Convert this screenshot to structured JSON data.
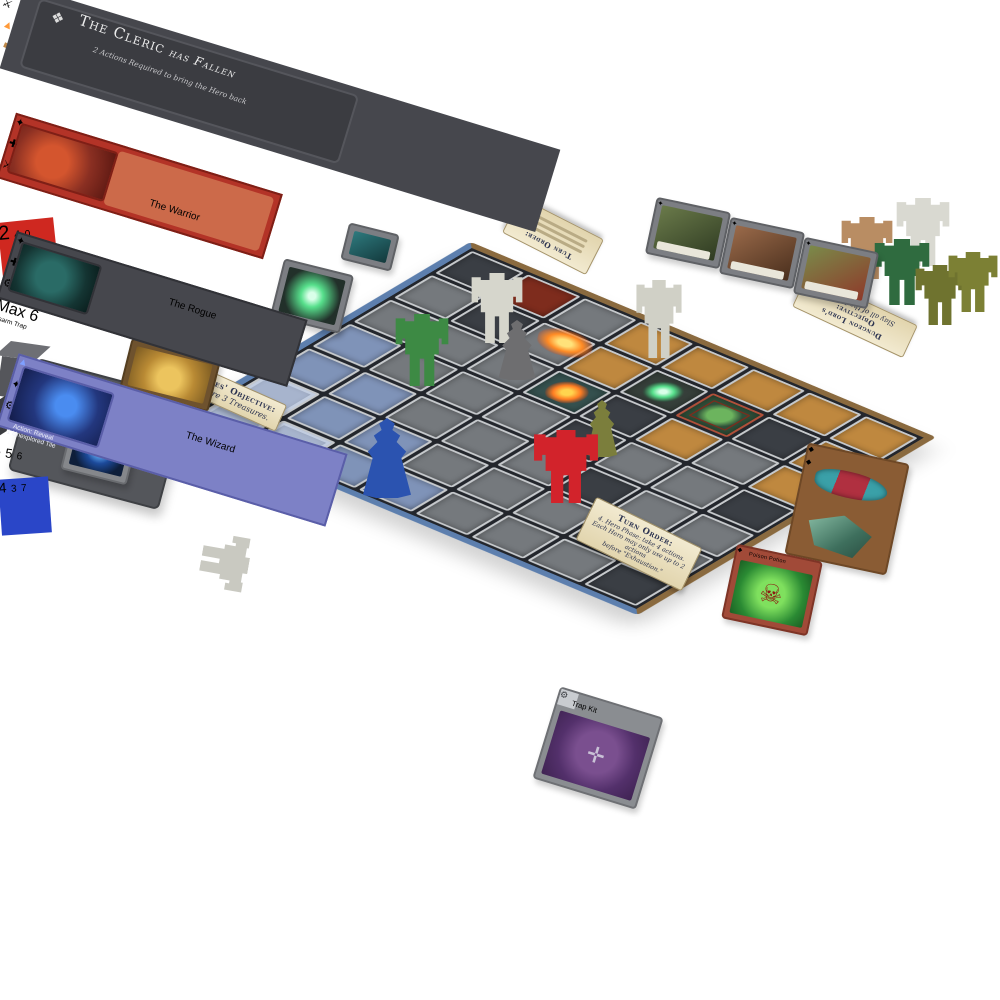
{
  "board": {
    "tiles": [
      [
        "d",
        "r",
        "g",
        "t",
        "t",
        "t",
        "t",
        "t"
      ],
      [
        "g",
        "d",
        "g",
        "t",
        "s",
        "m",
        "d",
        "t"
      ],
      [
        "g",
        "g",
        "g",
        "f",
        "d",
        "t",
        "g",
        "t"
      ],
      [
        "b",
        "g",
        "g",
        "g",
        "d",
        "g",
        "g",
        "d"
      ],
      [
        "b",
        "b",
        "g",
        "g",
        "g",
        "d",
        "g",
        "g"
      ],
      [
        "B",
        "b",
        "b",
        "g",
        "g",
        "g",
        "d",
        "g"
      ],
      [
        "B",
        "B",
        "b",
        "b",
        "g",
        "g",
        "g",
        "d"
      ]
    ],
    "heroes_objective": {
      "title": "Heroes' Objective:",
      "body": "Acquire 3 Treasures."
    },
    "hero_turn_order": {
      "title": "Turn Order:",
      "line1": "4. Hero Phase: take 4 actions.",
      "line2": "Each Hero may only use up to 2 actions",
      "line3": "before \"Exhaustion.\""
    },
    "dungeon_lord_objective": {
      "title": "Dungeon Lord's Objective:",
      "body": "Slay all of the Heroes."
    },
    "dungeon_lord_turn_order": {
      "title": "Turn Order:"
    }
  },
  "hero_boards": {
    "cleric": {
      "title": "The Cleric",
      "status": "has Fallen",
      "note": "2 Actions Required to bring the Hero back",
      "board_color": "#46474d"
    },
    "warrior": {
      "banner": "The Warrior",
      "board_color": "#b33327",
      "die": {
        "type": "d10",
        "color": "#cf2820",
        "face_front": "2",
        "face_left": "4",
        "face_top": "0"
      },
      "white_tokens": {
        "count": 2,
        "color": "#e9e9e3"
      }
    },
    "rogue": {
      "banner": "The Rogue",
      "slot1_label": "Max 6",
      "ability": "Disarm Trap",
      "board_color": "#46474d",
      "die": {
        "type": "d6",
        "color": "#55565b",
        "face_front": "4",
        "face_right": "5",
        "face_top": "6"
      }
    },
    "wizard": {
      "banner": "The Wizard",
      "ability_line1": "Action: Reveal",
      "ability_line2": "1 Unexplored Tile",
      "board_color": "#7d81c6",
      "die": {
        "type": "d8",
        "color": "#2a46c8",
        "face_left": "3",
        "face_top": "4",
        "face_bottom": "7"
      }
    }
  },
  "cards": {
    "trap_kit": {
      "title": "Trap Kit"
    },
    "poison_potion": {
      "title": "Poison Potion"
    }
  },
  "meeples": {
    "board": [
      {
        "name": "green-golem",
        "color": "#3d8a44"
      },
      {
        "name": "white-golem",
        "color": "#d6d6cc"
      },
      {
        "name": "gray-hero",
        "color": "#6e6e70"
      },
      {
        "name": "white-golem-2",
        "color": "#d0d0c6"
      },
      {
        "name": "olive-hero",
        "color": "#7b7e3c"
      },
      {
        "name": "blue-wizard",
        "color": "#2b53b0"
      },
      {
        "name": "red-warrior",
        "color": "#d2232b"
      }
    ],
    "fallen_cleric": {
      "color": "#c9c9c1"
    },
    "reserve": [
      {
        "name": "tan-golem",
        "color": "#b98d63"
      },
      {
        "name": "white-golem",
        "color": "#d9d9d1"
      },
      {
        "name": "dark-green-golem",
        "color": "#2f6b3f"
      },
      {
        "name": "olive-golem",
        "color": "#6f732f"
      },
      {
        "name": "olive-golem-2",
        "color": "#7c8034"
      }
    ]
  }
}
